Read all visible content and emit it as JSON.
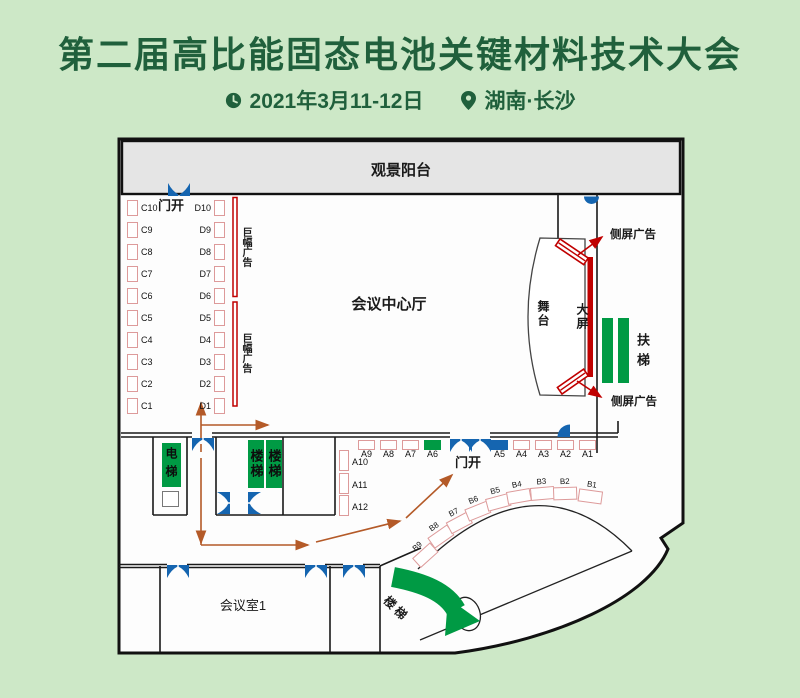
{
  "header": {
    "title": "第二届高比能固态电池关键材料技术大会",
    "date": "2021年3月11-12日",
    "location": "湖南·长沙"
  },
  "plan": {
    "balcony": "观景阳台",
    "hall": "会议中心厅",
    "door_open_top": "门开",
    "door_open_bottom": "门开",
    "banner_ad_top": "巨幅广告",
    "banner_ad_bottom": "巨幅广告",
    "stage": "舞台",
    "big_screen": "大屏",
    "side_screen_top": "侧屏广告",
    "side_screen_bottom": "侧屏广告",
    "escalator": "扶梯",
    "elevator": "电梯",
    "stairs_left": "楼梯",
    "stairs_right": "楼梯",
    "stairs_curved": "楼梯",
    "meeting_room": "会议室1",
    "booths": {
      "c": [
        "C10",
        "C9",
        "C8",
        "C7",
        "C6",
        "C5",
        "C4",
        "C3",
        "C2",
        "C1"
      ],
      "d": [
        "D10",
        "D9",
        "D8",
        "D7",
        "D6",
        "D5",
        "D4",
        "D3",
        "D2",
        "D1"
      ],
      "a_top": [
        "A9",
        "A8",
        "A7",
        "A6",
        "A5",
        "A4",
        "A3",
        "A2",
        "A1"
      ],
      "a_side": [
        "A10",
        "A11",
        "A12"
      ],
      "b": [
        "B9",
        "B8",
        "B7",
        "B6",
        "B5",
        "B4",
        "B3",
        "B2",
        "B1"
      ]
    }
  },
  "colors": {
    "background": "#cde8c7",
    "title_green": "#20603c",
    "shape_green": "#009a44",
    "door_blue": "#1565b0",
    "screen_red": "#c00000",
    "route_orange": "#b45a28",
    "booth_border": "#dd9a9a",
    "balcony_gray": "#e5e5e5"
  }
}
